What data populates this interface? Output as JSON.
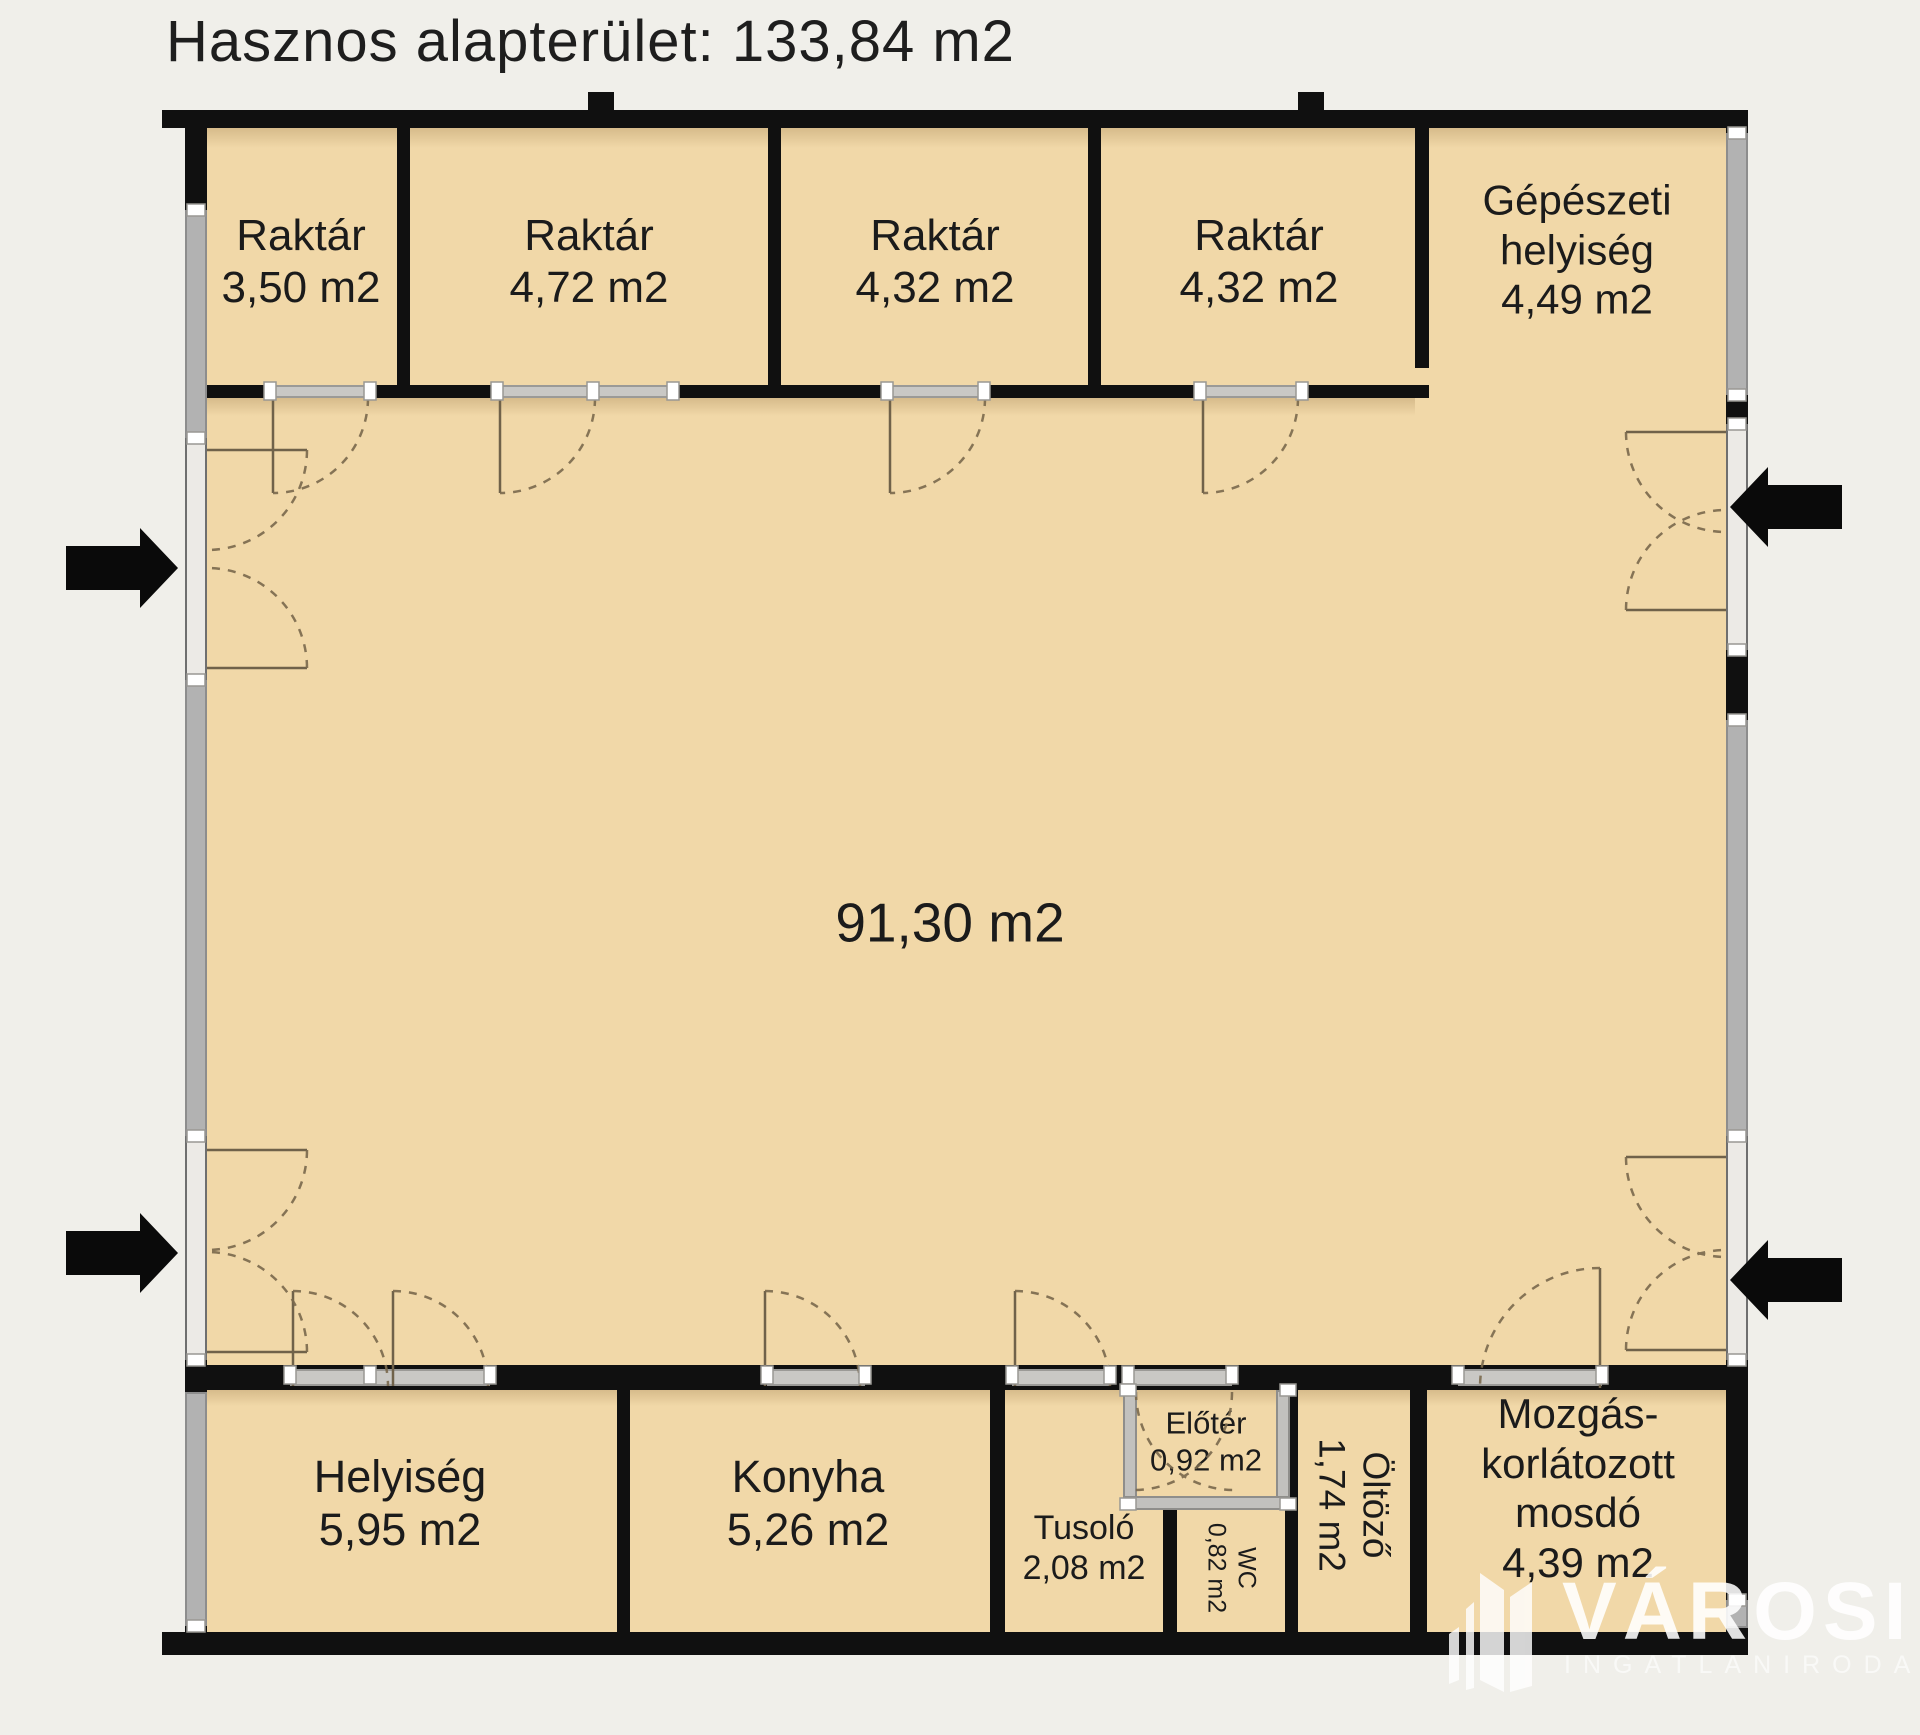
{
  "title": "Hasznos alapterület: 133,84 m2",
  "rooms": [
    {
      "id": "raktar-1",
      "name": "Raktár",
      "area": "3,50 m2",
      "label_lines": [
        "Raktár",
        "3,50 m2"
      ]
    },
    {
      "id": "raktar-2",
      "name": "Raktár",
      "area": "4,72 m2",
      "label_lines": [
        "Raktár",
        "4,72 m2"
      ]
    },
    {
      "id": "raktar-3",
      "name": "Raktár",
      "area": "4,32 m2",
      "label_lines": [
        "Raktár",
        "4,32 m2"
      ]
    },
    {
      "id": "raktar-4",
      "name": "Raktár",
      "area": "4,32 m2",
      "label_lines": [
        "Raktár",
        "4,32 m2"
      ]
    },
    {
      "id": "gepeszeti-helyiseg",
      "name": "Gépészeti helyiség",
      "area": "4,49 m2",
      "label_lines": [
        "Gépészeti",
        "helyiség",
        "4,49 m2"
      ]
    },
    {
      "id": "main-hall",
      "name": "",
      "area": "91,30 m2",
      "label_lines": [
        "91,30 m2"
      ]
    },
    {
      "id": "helyiseg",
      "name": "Helyiség",
      "area": "5,95 m2",
      "label_lines": [
        "Helyiség",
        "5,95 m2"
      ]
    },
    {
      "id": "konyha",
      "name": "Konyha",
      "area": "5,26 m2",
      "label_lines": [
        "Konyha",
        "5,26 m2"
      ]
    },
    {
      "id": "tusolo",
      "name": "Tusoló",
      "area": "2,08 m2",
      "label_lines": [
        "Tusoló",
        "2,08 m2"
      ]
    },
    {
      "id": "eloter",
      "name": "Előtér",
      "area": "0,92 m2",
      "label_lines": [
        "Előtér",
        "0,92 m2"
      ]
    },
    {
      "id": "wc",
      "name": "WC",
      "area": "0,82 m2",
      "label_lines": [
        "WC",
        "0,82 m2"
      ]
    },
    {
      "id": "oltozo",
      "name": "Öltöző",
      "area": "1,74 m2",
      "label_lines": [
        "Öltöző",
        "1,74 m2"
      ]
    },
    {
      "id": "mozgaskorlatozott-mosdo",
      "name": "Mozgáskorlátozott mosdó",
      "area": "4,39 m2",
      "label_lines": [
        "Mozgás-",
        "korlátozott",
        "mosdó",
        "4,39 m2"
      ]
    }
  ],
  "watermark": {
    "brand": "VÁROSI",
    "subtitle": "INGATLANIRODA"
  },
  "colors": {
    "background": "#f0efea",
    "floor": "#f1d8a8",
    "wall": "#101010",
    "window_gray": "#b2b2b2",
    "door_opening": "#eceae6",
    "arrow": "#0a0a0a",
    "watermark": "#ffffff"
  }
}
